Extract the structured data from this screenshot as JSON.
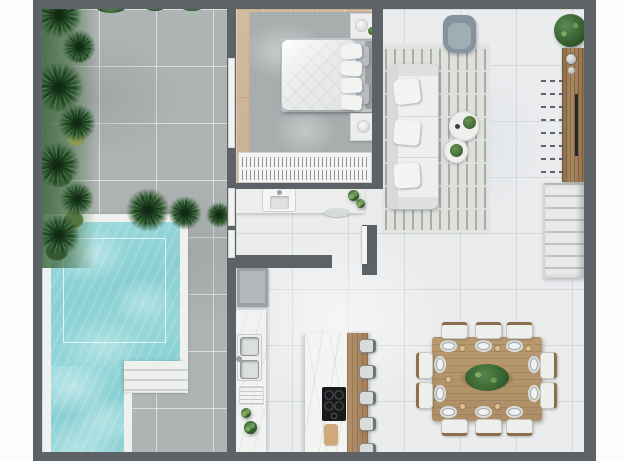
{
  "scene": {
    "type": "3d-rendered-floor-plan-top-view",
    "areas": [
      "terrace",
      "pool",
      "bedroom",
      "bathroom",
      "kitchen",
      "living-room",
      "dining-area",
      "staircase"
    ]
  },
  "palette": {
    "wall": "#5d6267",
    "margin": "#fcfcfc",
    "terrace-floor": "#aeb3b3",
    "interior-floor": "#eaecee",
    "wood-floor": "#cdb69a",
    "pool-water": "#8ed4d6",
    "pool-deck": "#f0f1ee",
    "rug-bedroom": "#a8adae",
    "rug-living": "#dfe1dd",
    "rug-living-line": "#a9aeaa",
    "armchair": "#85949c",
    "appliance": "#9ba1a4",
    "stair-tread": "#e9eae8",
    "foliage-dark": "#2b4e2e",
    "foliage-light": "#477549",
    "wood-furniture": "#ae8e66",
    "cooktop": "#17191b"
  },
  "outdoor": {
    "pool": {
      "shape": "L-shaped",
      "corner_steps": 3,
      "has_inner_depth_line": true
    },
    "palm_cluster_count": 10,
    "top_edge_plant_count": 5
  },
  "rooms": {
    "bedroom": {
      "floor": "wood",
      "items": [
        "double-bed",
        "quilted-duvet",
        "pillows",
        "headboard",
        "nightstand-with-lamp-top",
        "nightstand-with-lamp-bottom",
        "area-rug",
        "wardrobe-hanging-clothes",
        "terrace-door"
      ],
      "white_pillow_count": 4,
      "gray_pillow_count": 2
    },
    "bathroom": {
      "items": [
        "vanity-counter",
        "basin-sink",
        "faucet",
        "potted-plants",
        "oval-tray"
      ]
    },
    "kitchen": {
      "items": [
        "refrigerator",
        "wall-counter",
        "double-sink",
        "dish-rack",
        "counter-plants",
        "island-marble-top",
        "breakfast-bar-wood",
        "induction-cooktop",
        "cutting-board",
        "bar-stools"
      ],
      "bar_stool_count": 5,
      "cooktop_burner_count": 5
    },
    "living_room": {
      "items": [
        "three-seat-sofa",
        "sofa-pillows",
        "lounge-armchair",
        "coffee-table-large",
        "coffee-table-small",
        "table-plants",
        "geometric-maze-rug",
        "wood-media-console",
        "console-knobs",
        "potted-plant"
      ],
      "sofa_pillow_count": 3
    },
    "dining_area": {
      "items": [
        "wood-dining-table",
        "dining-chairs",
        "place-settings",
        "cups",
        "centerpiece-plant",
        "wood-tray"
      ],
      "chair_count": 10,
      "place_setting_count": 10
    },
    "staircase": {
      "visible_tread_count": 8,
      "upper_flight_shown_dashed": true
    }
  }
}
